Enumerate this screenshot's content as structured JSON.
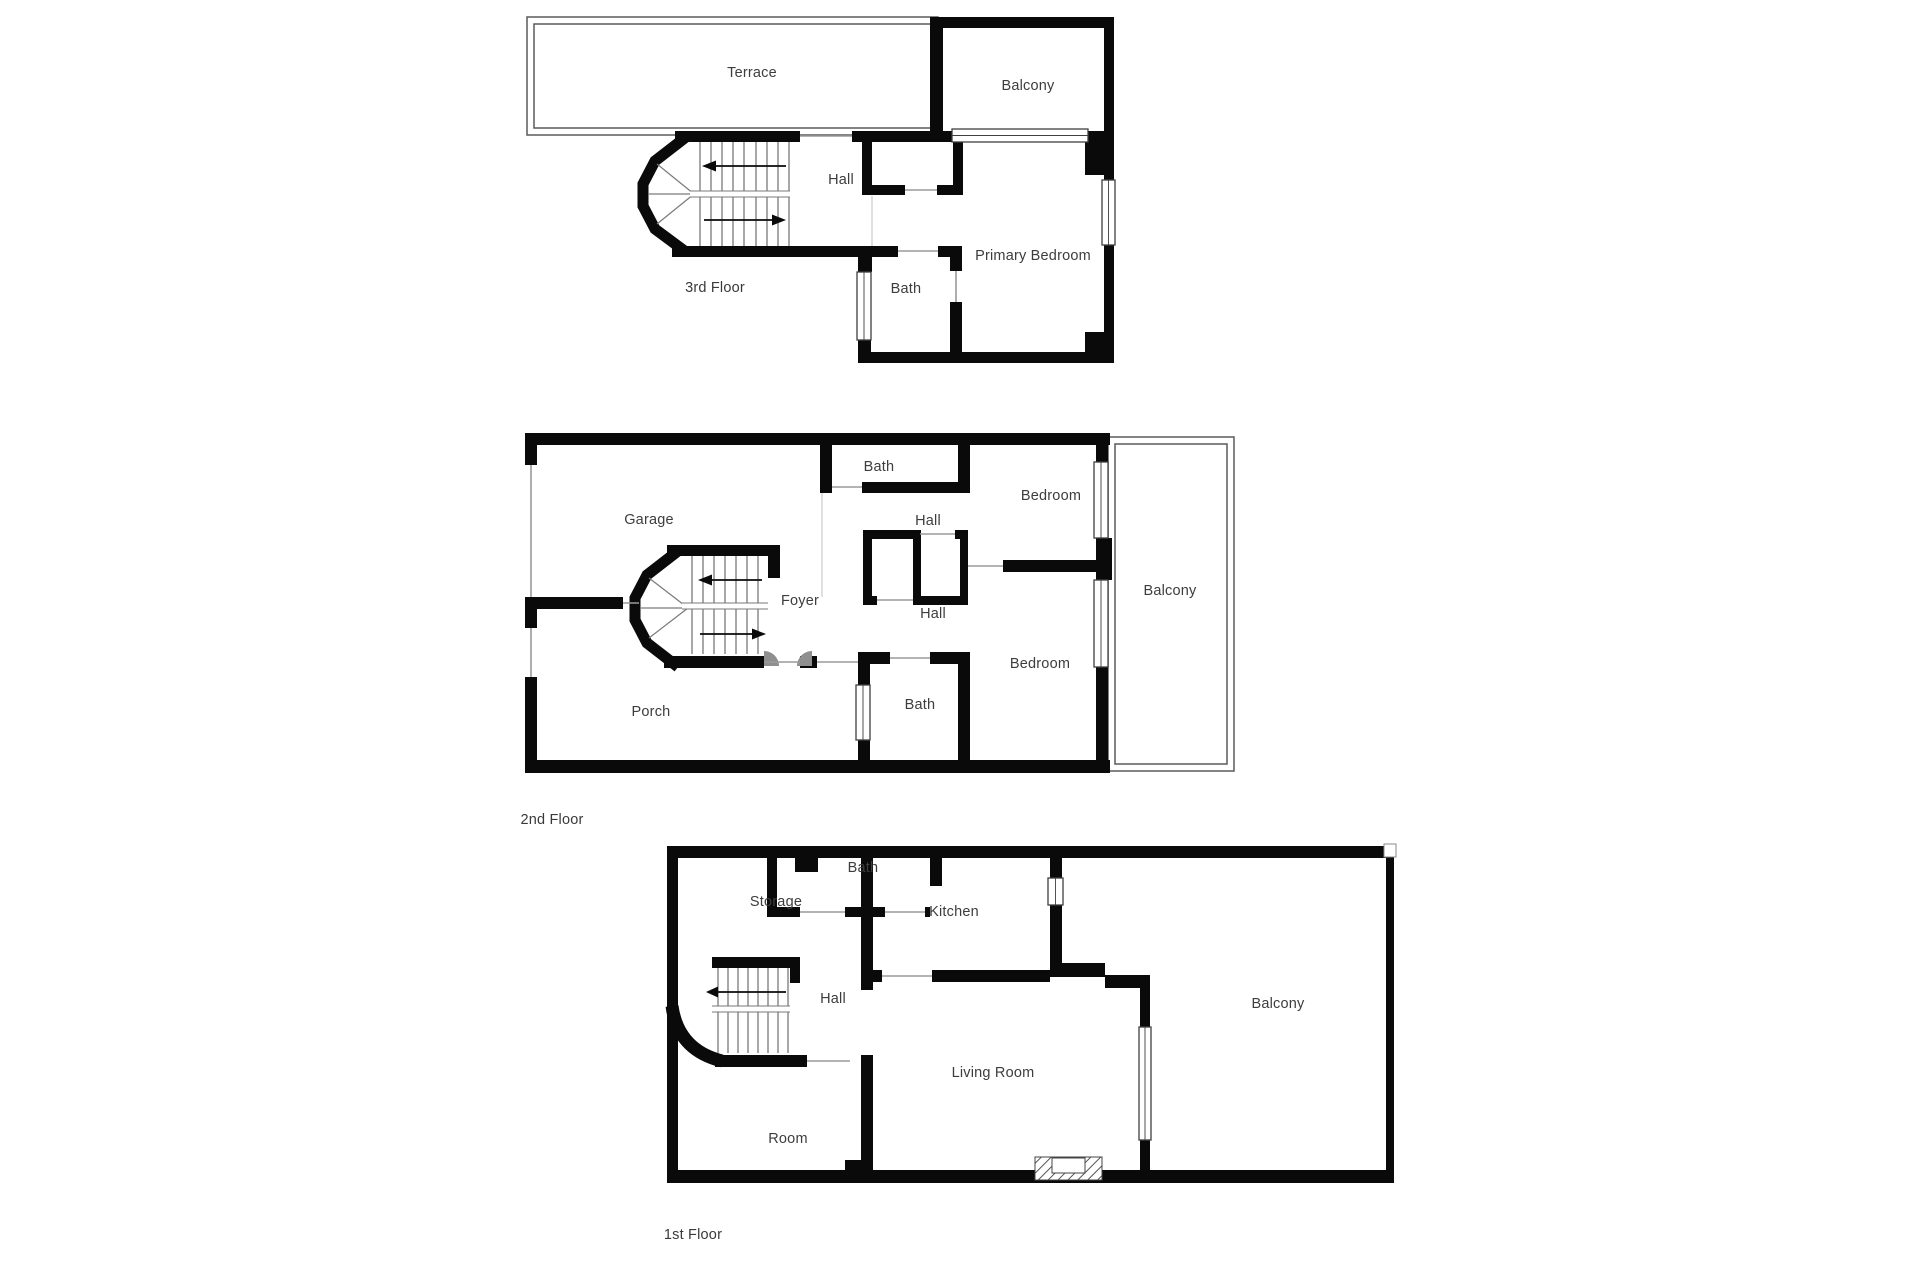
{
  "document": {
    "type": "floor-plan-set",
    "background": "#ffffff"
  },
  "colors": {
    "wall": "#0a0a0a",
    "label_text": "#3d3d3d",
    "door_line": "#9a9a9a",
    "window_line": "#3f3f3f",
    "terrace_outline": "#5a5a5a",
    "door_arc": "#8f8f8f"
  },
  "floors": [
    {
      "label": "3rd Floor",
      "rooms": [
        {
          "label": "Terrace"
        },
        {
          "label": "Balcony"
        },
        {
          "label": "Hall"
        },
        {
          "label": "Primary Bedroom"
        },
        {
          "label": "Bath"
        }
      ]
    },
    {
      "label": "2nd Floor",
      "rooms": [
        {
          "label": "Garage"
        },
        {
          "label": "Bath"
        },
        {
          "label": "Bedroom"
        },
        {
          "label": "Hall"
        },
        {
          "label": "Foyer"
        },
        {
          "label": "Hall"
        },
        {
          "label": "Balcony"
        },
        {
          "label": "Bedroom"
        },
        {
          "label": "Bath"
        },
        {
          "label": "Porch"
        }
      ]
    },
    {
      "label": "1st Floor",
      "rooms": [
        {
          "label": "Storage"
        },
        {
          "label": "Bath"
        },
        {
          "label": "Kitchen"
        },
        {
          "label": "Hall"
        },
        {
          "label": "Living Room"
        },
        {
          "label": "Balcony"
        },
        {
          "label": "Room"
        }
      ]
    }
  ]
}
